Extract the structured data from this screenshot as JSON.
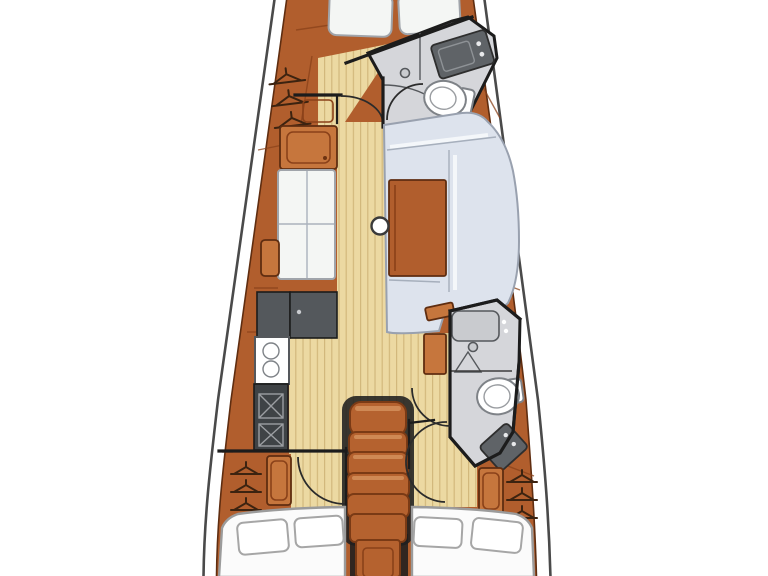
{
  "meta": {
    "title": "Sailboat interior layout plan",
    "diagram_type": "yacht floor plan, top-down view, no text labels visible"
  },
  "palette": {
    "bg": "#ffffff",
    "deck": "#ffffff",
    "hullLine": "#4a4a4a",
    "wood": "#b15e2d",
    "woodLight": "#c6763d",
    "woodDark": "#8a4119",
    "woodStroke": "#5f2d10",
    "floor": "#ecd9a2",
    "floorLine": "#d2b87c",
    "wall": "#1c1c1c",
    "cushion": "#f4f6f4",
    "cushionStroke": "#a0a4aa",
    "settee": "#dde3ed",
    "setteeHi": "#f6f8fb",
    "setteeStroke": "#99a1af",
    "counter": "#54585c",
    "counterDark": "#3f4346",
    "headFloor": "#d5d6da",
    "fixtureGray": "#c9cbcf",
    "sinkDark": "#5f6367",
    "steps": "#b5622f",
    "stepsHi": "#d3905c",
    "stepsStroke": "#7a3a15",
    "shadow": "#1f1f1f",
    "white": "#ffffff",
    "hanger": "#3c2310"
  },
  "rooms": [
    {
      "name": "forward-cabin",
      "features": [
        "v-berth-cushion x2",
        "hanging-locker",
        "door-swing-arc"
      ]
    },
    {
      "name": "forward-head",
      "features": [
        "toilet",
        "washbasin",
        "shower-drain",
        "shower-curtain-arc",
        "door-swing-arc"
      ]
    },
    {
      "name": "saloon",
      "features": [
        "port-settee 2x2 cushions",
        "side-cabinet",
        "c-shaped-settee",
        "saloon-table",
        "mast-step"
      ]
    },
    {
      "name": "galley",
      "features": [
        "worktop x2",
        "two-burner-stove",
        "double-sink"
      ]
    },
    {
      "name": "companionway",
      "features": [
        "steps x5",
        "base-landing",
        "engine-column"
      ]
    },
    {
      "name": "aft-head",
      "features": [
        "shower-shelf",
        "shower-drain",
        "toilet",
        "washbasin",
        "door-swing-arc"
      ]
    },
    {
      "name": "port-aft-cabin",
      "features": [
        "double-berth",
        "pillow x2",
        "hanging-locker",
        "cabinet",
        "door-swing-arc"
      ]
    },
    {
      "name": "starboard-aft-cabin",
      "features": [
        "double-berth",
        "pillow x2",
        "hanging-locker",
        "cabinet",
        "door-swing-arc"
      ]
    }
  ],
  "icons": [
    "toilet-icon",
    "washbasin-icon",
    "burner-icon",
    "sink-basin-icon",
    "hanger-icon",
    "mast-step-icon",
    "drain-icon",
    "door-arc-icon"
  ]
}
